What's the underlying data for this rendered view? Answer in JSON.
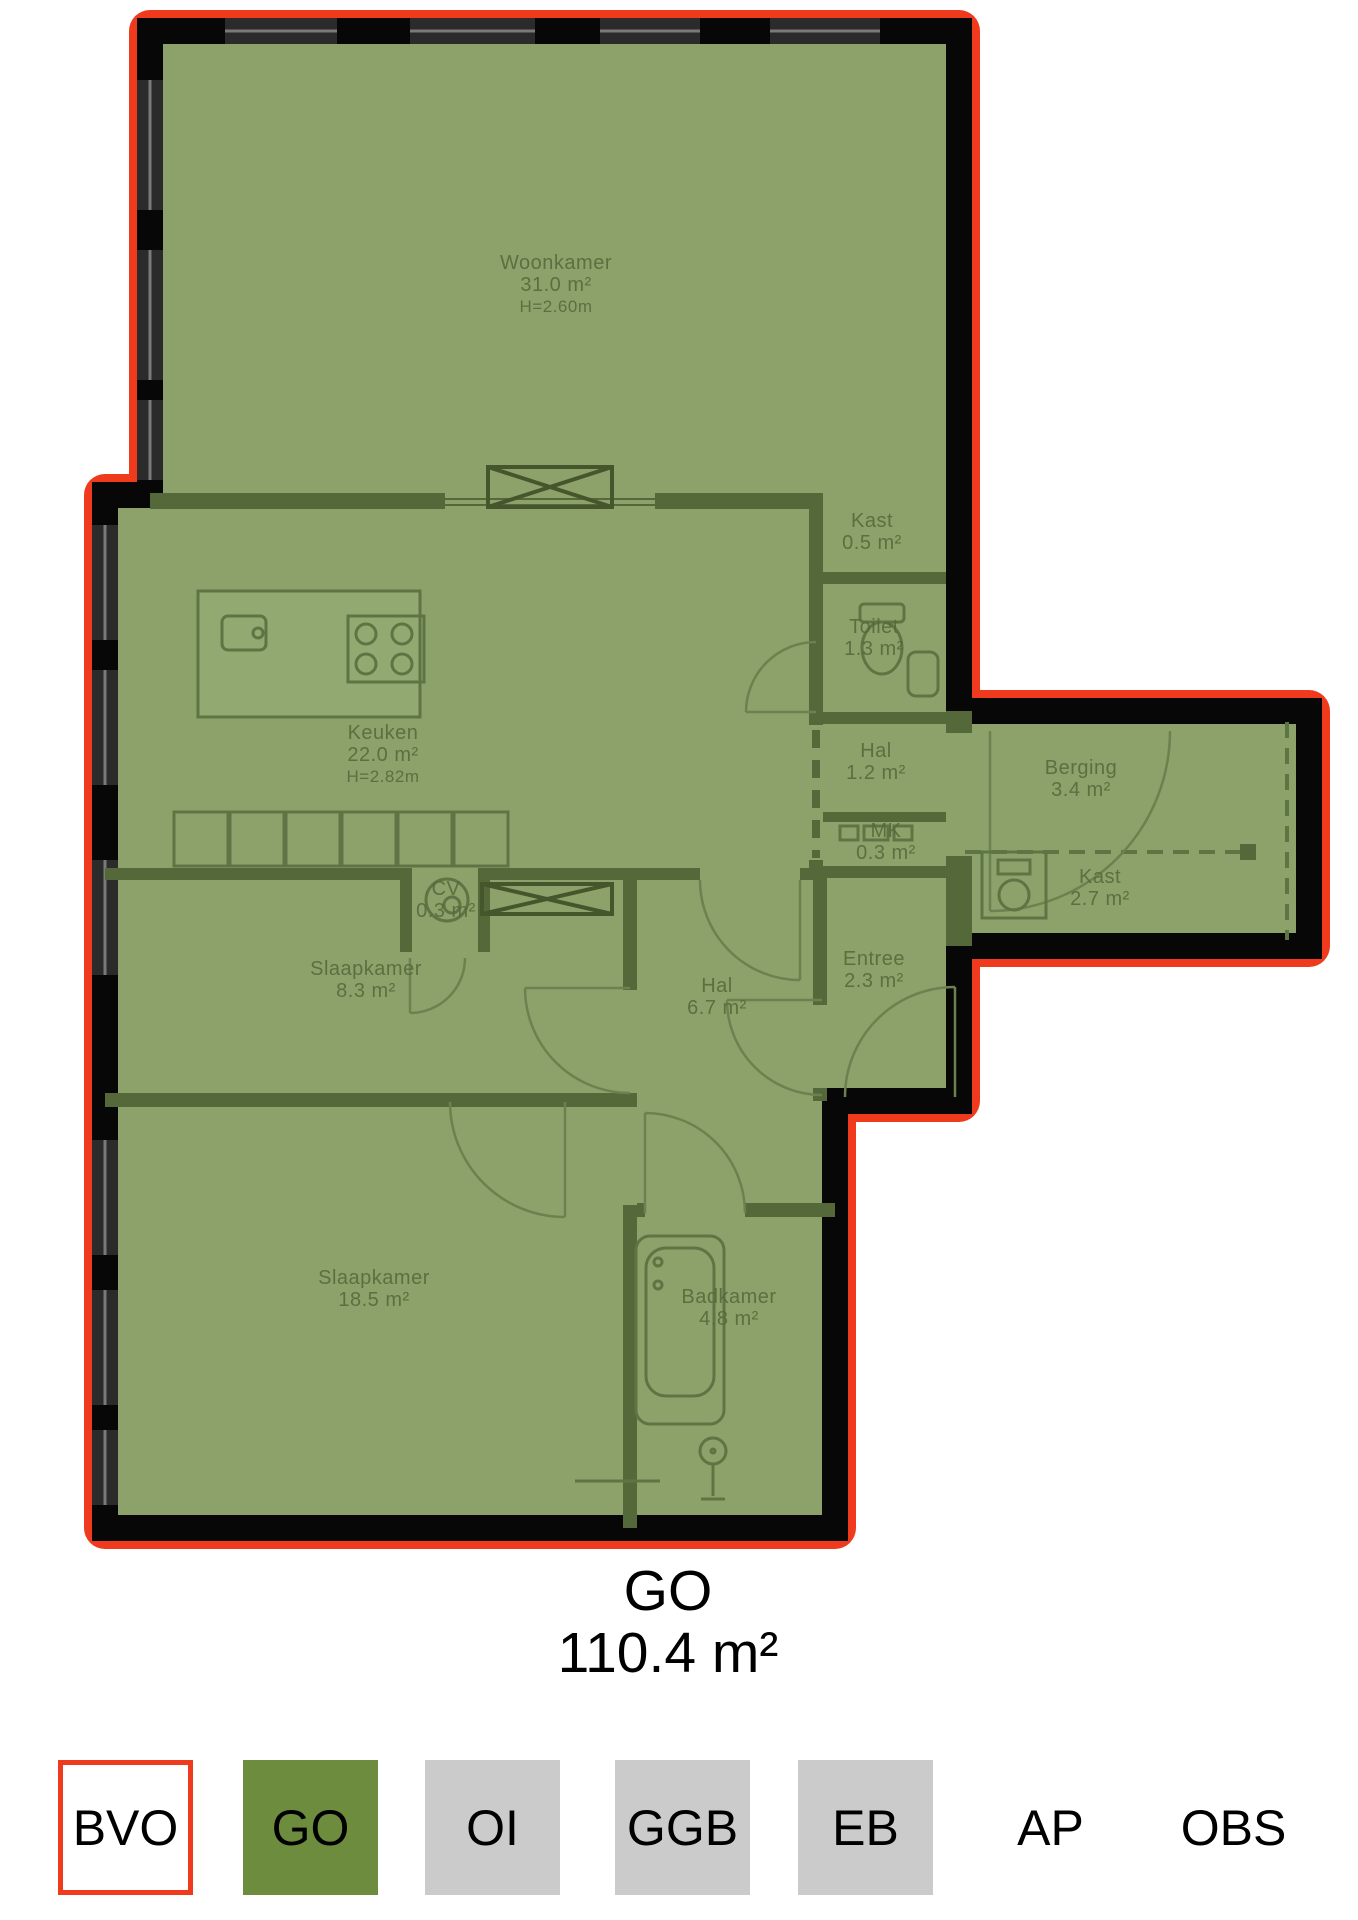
{
  "plan": {
    "rooms": [
      {
        "name": "Woonkamer",
        "area": "31.0 m²",
        "height": "H=2.60m"
      },
      {
        "name": "Keuken",
        "area": "22.0 m²",
        "height": "H=2.82m"
      },
      {
        "name": "Kast",
        "area": "0.5 m²"
      },
      {
        "name": "Toilet",
        "area": "1.3 m²"
      },
      {
        "name": "Hal",
        "area": "1.2 m²"
      },
      {
        "name": "Berging",
        "area": "3.4 m²"
      },
      {
        "name": "MK",
        "area": "0.3 m²"
      },
      {
        "name": "Kast",
        "area": "2.7 m²"
      },
      {
        "name": "CV",
        "area": "0.3 m²"
      },
      {
        "name": "Slaapkamer",
        "area": "8.3 m²"
      },
      {
        "name": "Hal",
        "area": "6.7 m²"
      },
      {
        "name": "Entree",
        "area": "2.3 m²"
      },
      {
        "name": "Slaapkamer",
        "area": "18.5 m²"
      },
      {
        "name": "Badkamer",
        "area": "4.8 m²"
      }
    ],
    "total": {
      "label": "GO",
      "area": "110.4 m²"
    }
  },
  "legend": {
    "items": [
      {
        "label": "BVO",
        "swatch": "outline-red"
      },
      {
        "label": "GO",
        "swatch": "green"
      },
      {
        "label": "OI",
        "swatch": "gray"
      },
      {
        "label": "GGB",
        "swatch": "gray"
      },
      {
        "label": "EB",
        "swatch": "gray"
      },
      {
        "label": "AP",
        "swatch": "none"
      },
      {
        "label": "OBS",
        "swatch": "none"
      }
    ]
  },
  "colors": {
    "highlight_red": "#ef3a1e",
    "overlay_green": "#8ca26a",
    "legend_green": "#6e8c3e",
    "legend_gray": "#cbcbcb"
  }
}
